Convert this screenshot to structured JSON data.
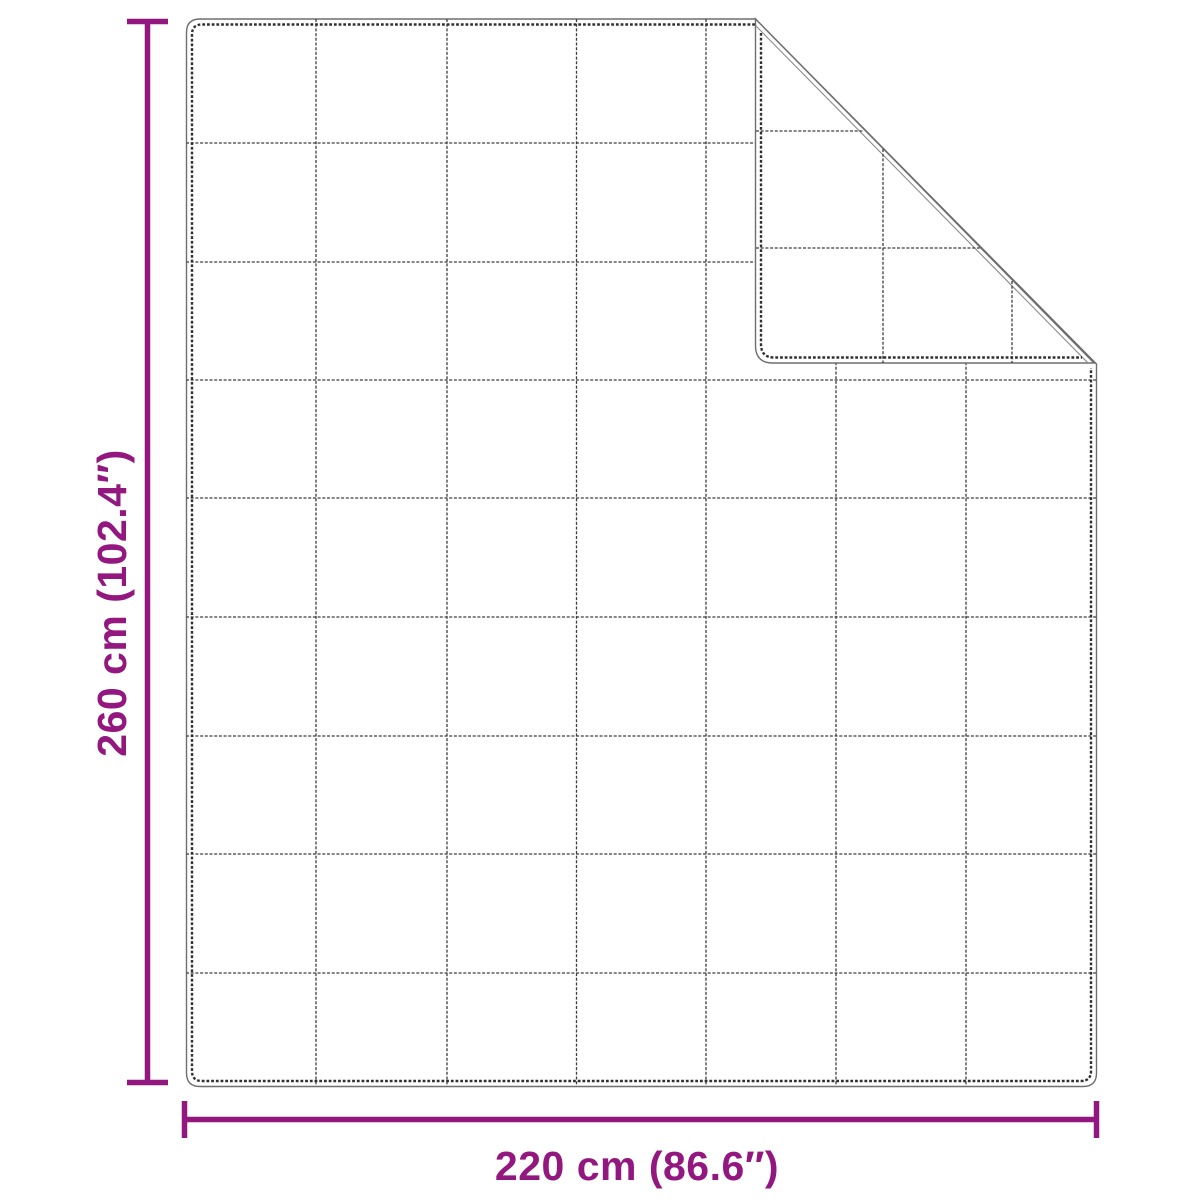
{
  "diagram": {
    "type": "product-dimension-diagram",
    "subject": "weighted-blanket-with-quilted-grid-and-folded-corner",
    "height_label": "260 cm (102.4″)",
    "width_label": "220 cm (86.6″)",
    "dimensions": {
      "height_cm": 260,
      "height_inches": 102.4,
      "width_cm": 220,
      "width_inches": 86.6
    },
    "grid": {
      "columns": 7,
      "rows": 9
    },
    "colors": {
      "dimension_accent": "#921880",
      "outline": "#6e6e6e",
      "stitch": "#303030",
      "background": "#ffffff"
    }
  }
}
